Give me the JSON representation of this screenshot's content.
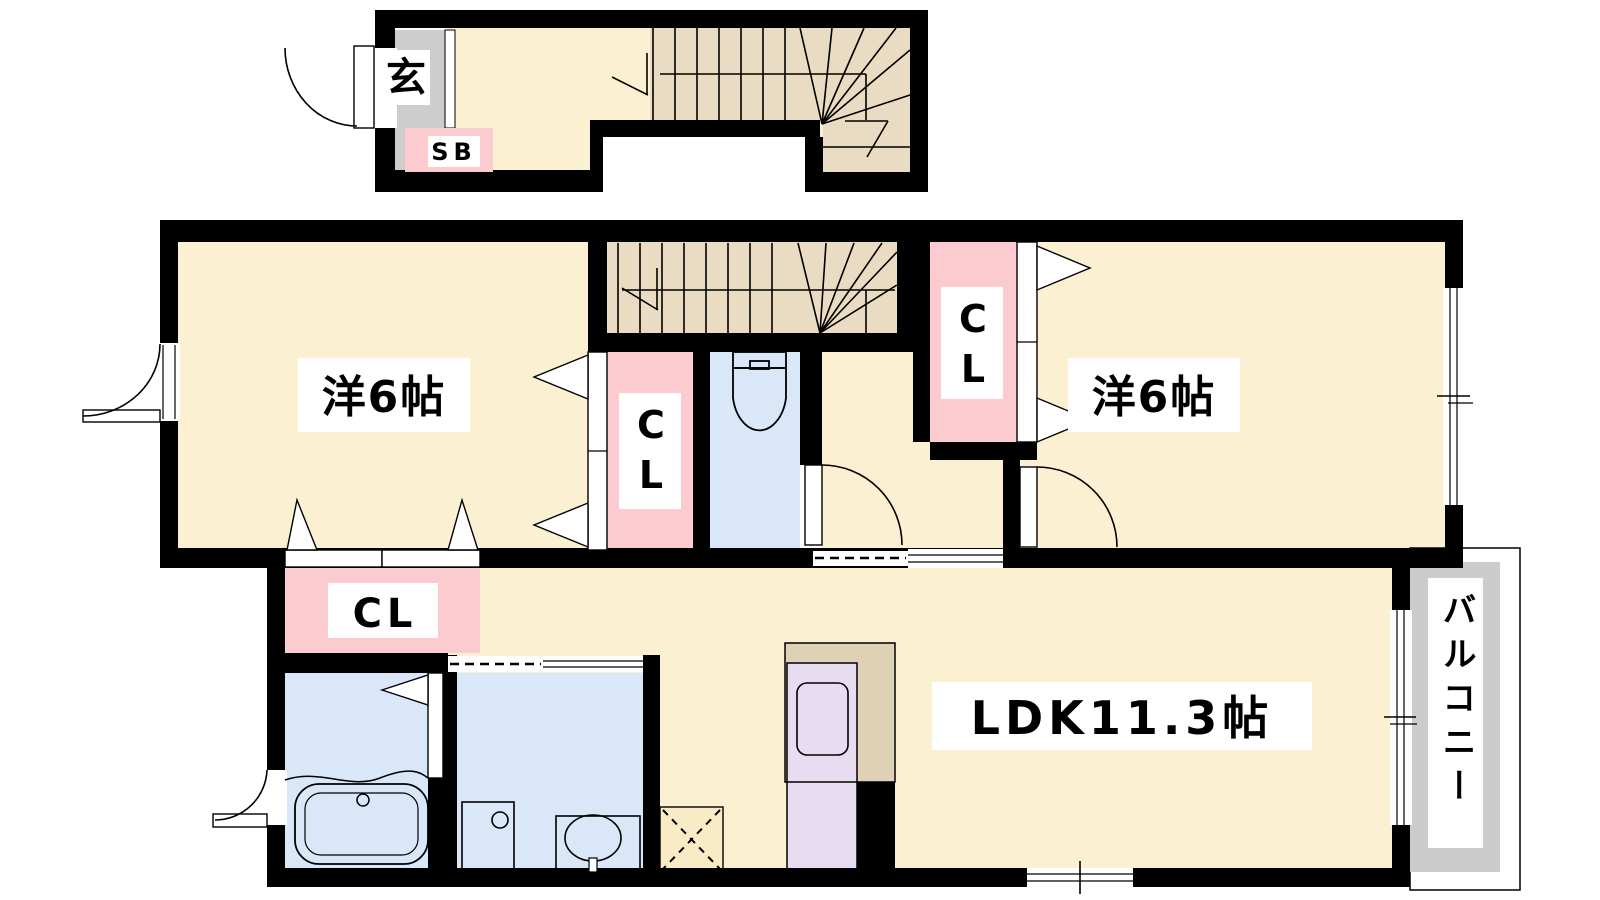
{
  "floor_plan": {
    "first_floor": {
      "entrance_label": "玄",
      "shoe_box_label": "SB"
    },
    "second_floor": {
      "bedroom_left_label": "洋6帖",
      "bedroom_right_label": "洋6帖",
      "closet_mid_left_label": "CL",
      "closet_mid_right_label": "CL",
      "closet_lower_label": "CL",
      "ldk_label": "LDK11.3帖",
      "balcony_label": "バルコニー"
    },
    "colors": {
      "wall_black": "#000000",
      "floor_cream": "#FBF0D2",
      "stairs_tan": "#E9DCC2",
      "closet_pink": "#FBCBD0",
      "wet_area_blue": "#D9E7F8",
      "kitchen_purple": "#E8DCF3",
      "kitchen_counter_tan": "#DFD1B5",
      "entrance_gray": "#CDCDCD",
      "balcony_gray": "#CCCCCC",
      "refrigerator_cream": "#FAEBC7"
    }
  }
}
